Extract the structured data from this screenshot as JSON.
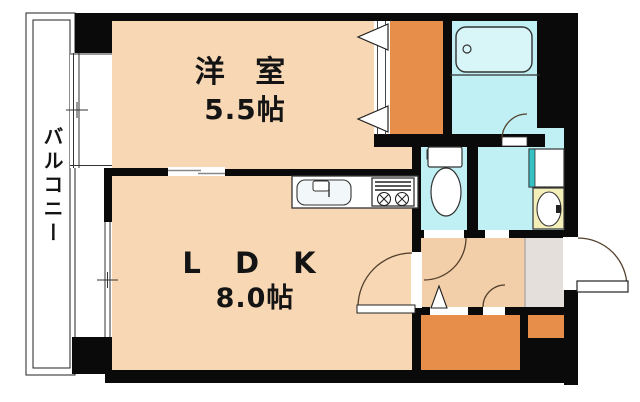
{
  "floor_plan": {
    "type": "apartment-floor-plan",
    "balcony_label": "バルコニー",
    "rooms": [
      {
        "id": "western-room",
        "name": "洋 室",
        "size": "5.5帖"
      },
      {
        "id": "ldk",
        "name": "L D K",
        "size": "8.0帖"
      }
    ],
    "fixtures": [
      "bathtub-icon",
      "toilet-icon",
      "washbasin-icon",
      "washing-machine-pan-icon",
      "kitchen-sink-icon",
      "gas-stove-icon",
      "closet",
      "entrance-door",
      "sliding-window",
      "sliding-door",
      "door-swing-arc"
    ],
    "colors": {
      "room_floor": "#F8D8B4",
      "hallway_floor": "#F2CFA9",
      "closet_orange": "#E78E4B",
      "wet_area_cyan": "#C0EFF4",
      "bathtub_fill": "#D8F6F8",
      "washbasin_yellow": "#F4EFB9",
      "entrance_gray": "#E4DFDB",
      "accent_teal": "#35C0C4",
      "wall_black": "#0A0A0A"
    }
  }
}
